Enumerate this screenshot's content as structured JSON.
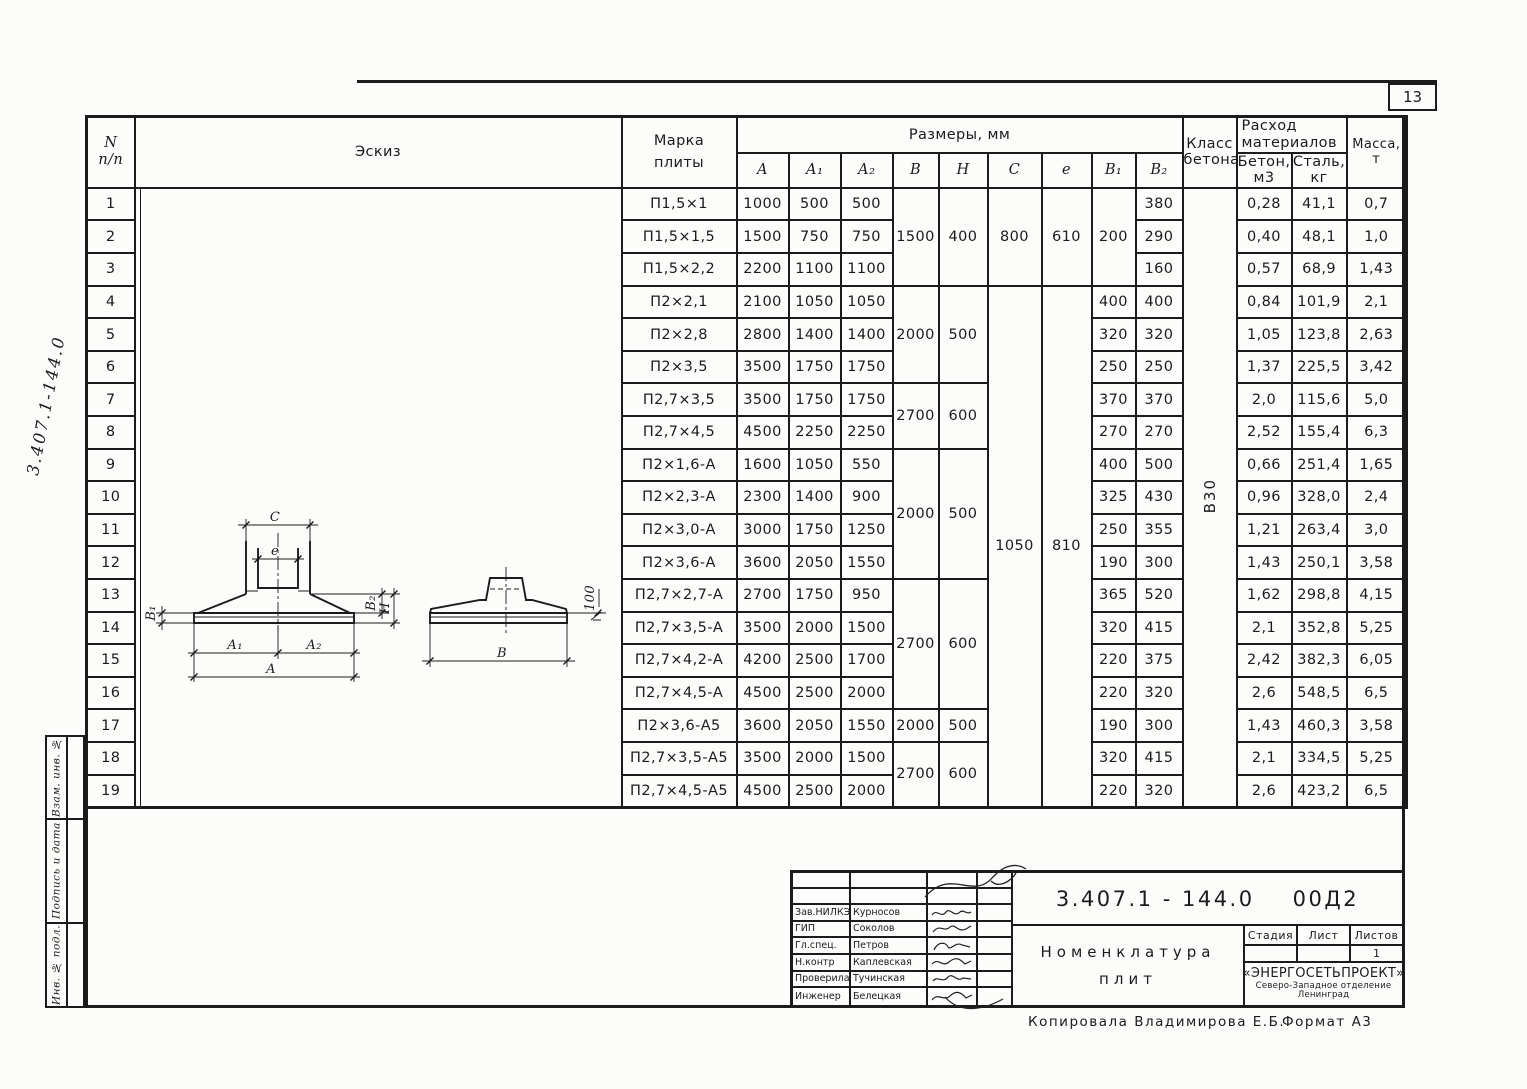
{
  "page": {
    "number": "13",
    "side_number": "3.407.1-144.0"
  },
  "sidebar": {
    "labels": [
      "Взам. инв. №",
      "Подпись и дата",
      "Инв. № подл."
    ]
  },
  "footer": {
    "copied": "Копировала  Владимирова Е.Б.",
    "format": "Формат А3"
  },
  "table": {
    "header": {
      "num_top": "N",
      "num_bottom": "п/п",
      "sketch": "Эскиз",
      "marka_1": "Марка",
      "marka_2": "плиты",
      "sizes": "Размеры, мм",
      "col_a": "А",
      "col_a1": "А₁",
      "col_a2": "А₂",
      "col_b": "В",
      "col_h": "Н",
      "col_c": "С",
      "col_e": "е",
      "col_b1": "В₁",
      "col_b2": "В₂",
      "class_1": "Класс",
      "class_2": "бетона",
      "consumption_1": "Расход",
      "consumption_2": "материалов",
      "concrete": "Бетон, м3",
      "steel": "Сталь, кг",
      "mass": "Масса, т"
    },
    "concrete_class": "В30",
    "rows": [
      {
        "n": "1",
        "marka": "П1,5×1",
        "a": "1000",
        "a1": "500",
        "a2": "500",
        "b": "1500",
        "h": "400",
        "c": "800",
        "e": "610",
        "b1": "200",
        "b2": "380",
        "beton": "0,28",
        "stal": "41,1",
        "massa": "0,7"
      },
      {
        "n": "2",
        "marka": "П1,5×1,5",
        "a": "1500",
        "a1": "750",
        "a2": "750",
        "b2": "290",
        "beton": "0,40",
        "stal": "48,1",
        "massa": "1,0"
      },
      {
        "n": "3",
        "marka": "П1,5×2,2",
        "a": "2200",
        "a1": "1100",
        "a2": "1100",
        "b2": "160",
        "beton": "0,57",
        "stal": "68,9",
        "massa": "1,43"
      },
      {
        "n": "4",
        "marka": "П2×2,1",
        "a": "2100",
        "a1": "1050",
        "a2": "1050",
        "b": "2000",
        "h": "500",
        "c": "1050",
        "e": "810",
        "b1": "400",
        "b2": "400",
        "beton": "0,84",
        "stal": "101,9",
        "massa": "2,1"
      },
      {
        "n": "5",
        "marka": "П2×2,8",
        "a": "2800",
        "a1": "1400",
        "a2": "1400",
        "b1": "320",
        "b2": "320",
        "beton": "1,05",
        "stal": "123,8",
        "massa": "2,63"
      },
      {
        "n": "6",
        "marka": "П2×3,5",
        "a": "3500",
        "a1": "1750",
        "a2": "1750",
        "b1": "250",
        "b2": "250",
        "beton": "1,37",
        "stal": "225,5",
        "massa": "3,42"
      },
      {
        "n": "7",
        "marka": "П2,7×3,5",
        "a": "3500",
        "a1": "1750",
        "a2": "1750",
        "b": "2700",
        "h": "600",
        "b1": "370",
        "b2": "370",
        "beton": "2,0",
        "stal": "115,6",
        "massa": "5,0"
      },
      {
        "n": "8",
        "marka": "П2,7×4,5",
        "a": "4500",
        "a1": "2250",
        "a2": "2250",
        "b1": "270",
        "b2": "270",
        "beton": "2,52",
        "stal": "155,4",
        "massa": "6,3"
      },
      {
        "n": "9",
        "marka": "П2×1,6-А",
        "a": "1600",
        "a1": "1050",
        "a2": "550",
        "b": "2000",
        "h": "500",
        "b1": "400",
        "b2": "500",
        "beton": "0,66",
        "stal": "251,4",
        "massa": "1,65"
      },
      {
        "n": "10",
        "marka": "П2×2,3-А",
        "a": "2300",
        "a1": "1400",
        "a2": "900",
        "b1": "325",
        "b2": "430",
        "beton": "0,96",
        "stal": "328,0",
        "massa": "2,4"
      },
      {
        "n": "11",
        "marka": "П2×3,0-А",
        "a": "3000",
        "a1": "1750",
        "a2": "1250",
        "b1": "250",
        "b2": "355",
        "beton": "1,21",
        "stal": "263,4",
        "massa": "3,0"
      },
      {
        "n": "12",
        "marka": "П2×3,6-А",
        "a": "3600",
        "a1": "2050",
        "a2": "1550",
        "b1": "190",
        "b2": "300",
        "beton": "1,43",
        "stal": "250,1",
        "massa": "3,58"
      },
      {
        "n": "13",
        "marka": "П2,7×2,7-А",
        "a": "2700",
        "a1": "1750",
        "a2": "950",
        "b": "2700",
        "h": "600",
        "b1": "365",
        "b2": "520",
        "beton": "1,62",
        "stal": "298,8",
        "massa": "4,15"
      },
      {
        "n": "14",
        "marka": "П2,7×3,5-А",
        "a": "3500",
        "a1": "2000",
        "a2": "1500",
        "b1": "320",
        "b2": "415",
        "beton": "2,1",
        "stal": "352,8",
        "massa": "5,25"
      },
      {
        "n": "15",
        "marka": "П2,7×4,2-А",
        "a": "4200",
        "a1": "2500",
        "a2": "1700",
        "b1": "220",
        "b2": "375",
        "beton": "2,42",
        "stal": "382,3",
        "massa": "6,05"
      },
      {
        "n": "16",
        "marka": "П2,7×4,5-А",
        "a": "4500",
        "a1": "2500",
        "a2": "2000",
        "b1": "220",
        "b2": "320",
        "beton": "2,6",
        "stal": "548,5",
        "massa": "6,5"
      },
      {
        "n": "17",
        "marka": "П2×3,6-А5",
        "a": "3600",
        "a1": "2050",
        "a2": "1550",
        "b": "2000",
        "h": "500",
        "b1": "190",
        "b2": "300",
        "beton": "1,43",
        "stal": "460,3",
        "massa": "3,58"
      },
      {
        "n": "18",
        "marka": "П2,7×3,5-А5",
        "a": "3500",
        "a1": "2000",
        "a2": "1500",
        "b": "2700",
        "h": "600",
        "b1": "320",
        "b2": "415",
        "beton": "2,1",
        "stal": "334,5",
        "massa": "5,25"
      },
      {
        "n": "19",
        "marka": "П2,7×4,5-А5",
        "a": "4500",
        "a1": "2500",
        "a2": "2000",
        "b1": "220",
        "b2": "320",
        "beton": "2,6",
        "stal": "423,2",
        "massa": "6,5"
      }
    ]
  },
  "sketch": {
    "c": "С",
    "e": "е",
    "b1": "В₁",
    "b2": "В₂",
    "h": "Н",
    "a1": "А₁",
    "a2": "А₂",
    "a": "А",
    "b": "В",
    "slope_value": "100"
  },
  "title_block": {
    "doc_number": "3.407.1 - 144.0",
    "doc_suffix": "00Д2",
    "title_1": "Номенклатура",
    "title_2": "плит",
    "stage_label": "Стадия",
    "sheet_label": "Лист",
    "sheets_label": "Листов",
    "sheets_value": "1",
    "org_1": "«ЭНЕРГОСЕТЬПРОЕКТ»",
    "org_2": "Северо-Западное отделение",
    "org_3": "Ленинград",
    "rows": [
      {
        "role": "Зав.НИЛКЭ",
        "name": "Курносов"
      },
      {
        "role": "ГИП",
        "name": "Соколов"
      },
      {
        "role": "Гл.спец.",
        "name": "Петров"
      },
      {
        "role": "Н.контр",
        "name": "Каплевская"
      },
      {
        "role": "Проверила",
        "name": "Тучинская"
      },
      {
        "role": "Инженер",
        "name": "Белецкая"
      }
    ]
  }
}
